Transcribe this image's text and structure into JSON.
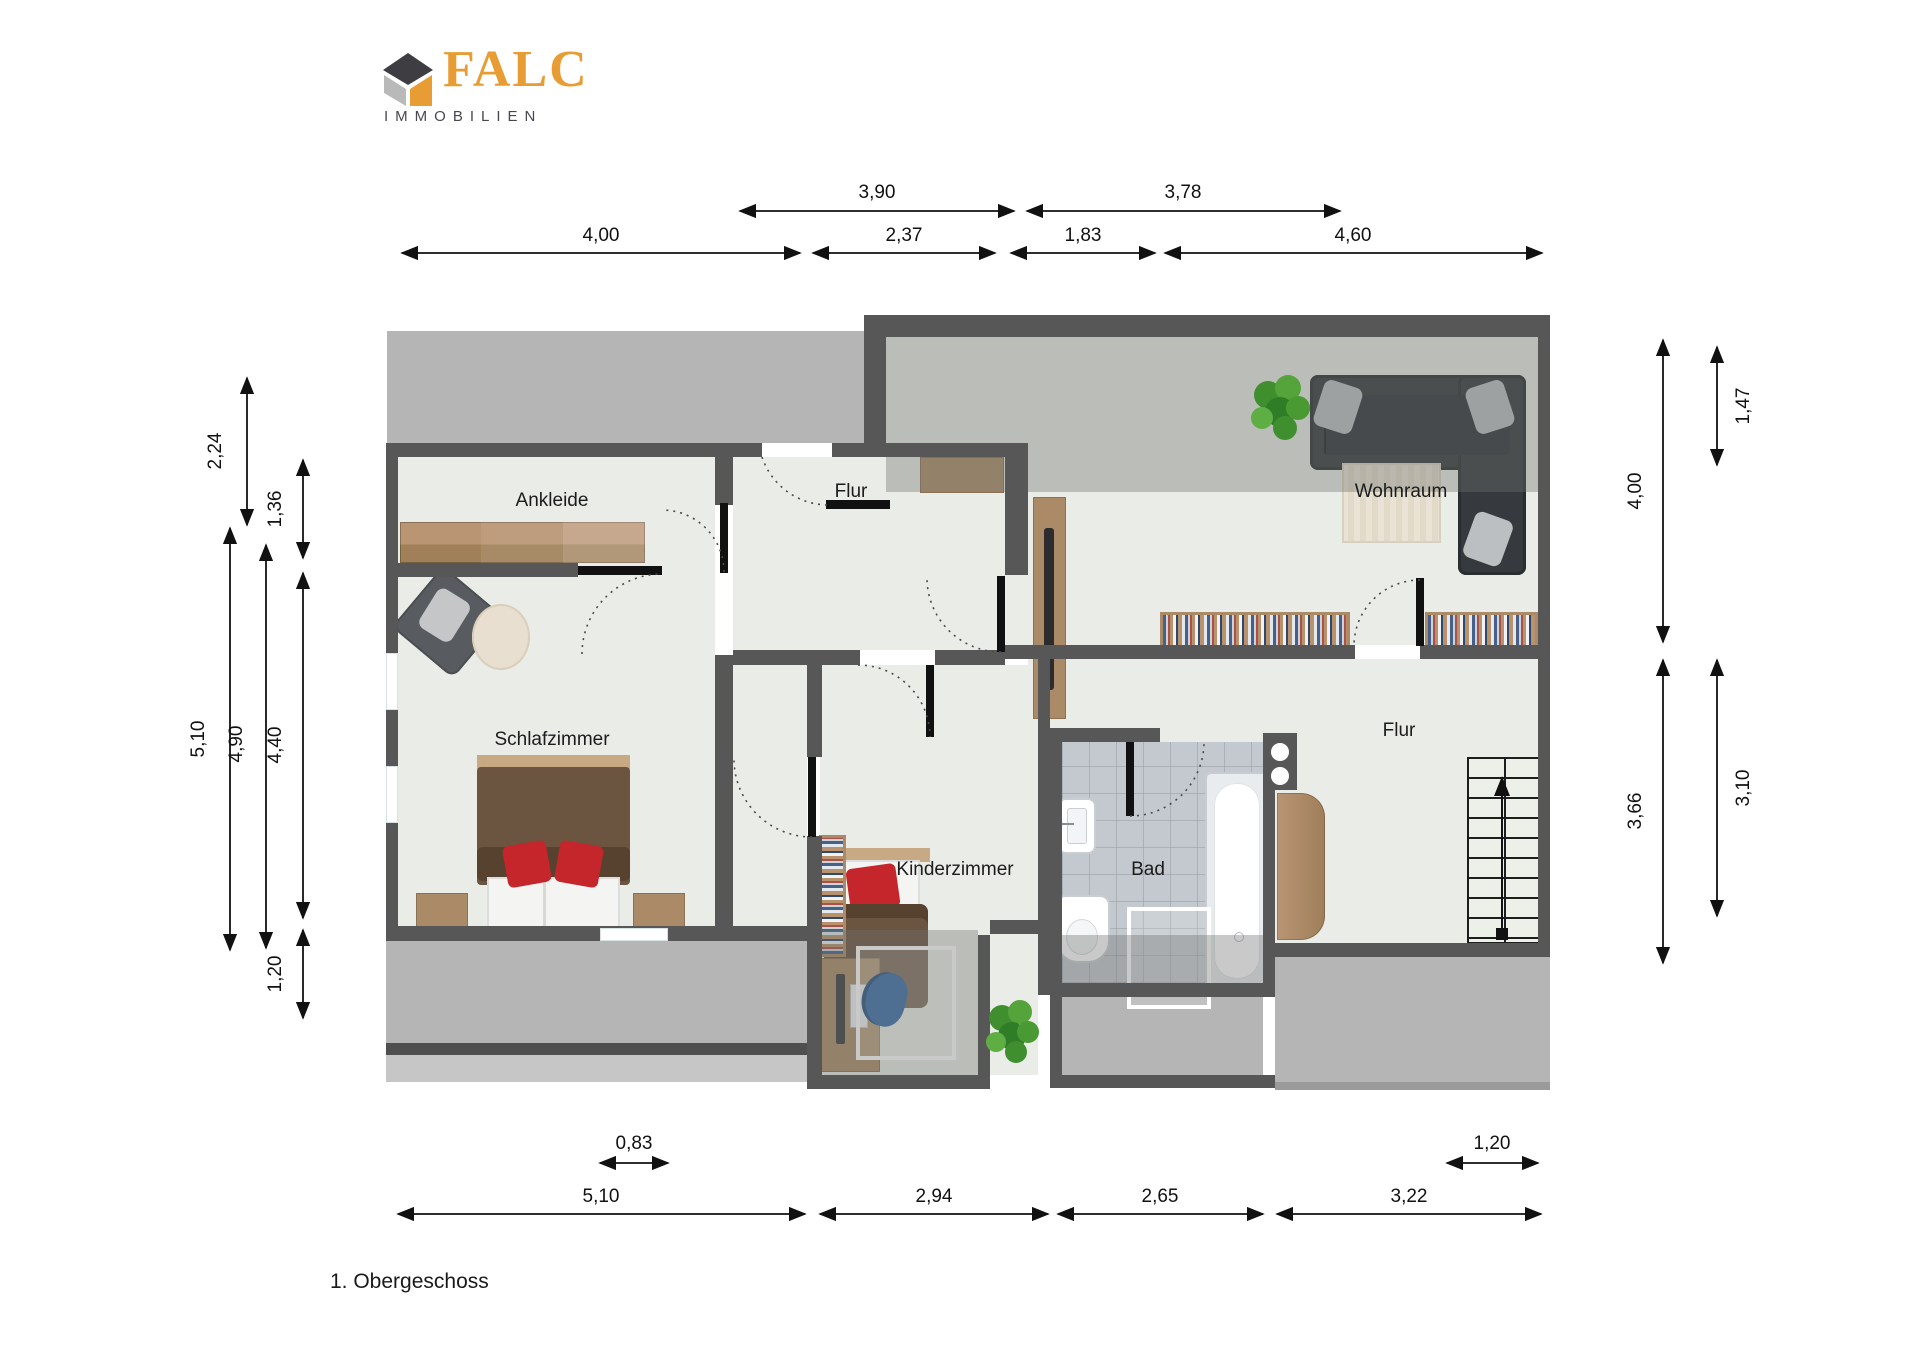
{
  "logo": {
    "brand": "FALC",
    "subtitle": "IMMOBILIEN"
  },
  "caption": "1. Obergeschoss",
  "rooms": {
    "ankleide": "Ankleide",
    "flur_mitte": "Flur",
    "wohnraum": "Wohnraum",
    "schlafzimmer": "Schlafzimmer",
    "kinderzimmer": "Kinderzimmer",
    "bad": "Bad",
    "flur_rechts": "Flur"
  },
  "dimensions": {
    "top_row1": {
      "w390": "3,90",
      "w378": "3,78"
    },
    "top_row2": {
      "w400": "4,00",
      "w237": "2,37",
      "w183": "1,83",
      "w460": "4,60"
    },
    "left": {
      "l224": "2,24",
      "l510": "5,10",
      "l490": "4,90",
      "l136": "1,36",
      "l440": "4,40",
      "l120": "1,20"
    },
    "right": {
      "r147": "1,47",
      "r400": "4,00",
      "r366": "3,66",
      "r310": "3,10"
    },
    "bottom_row1": {
      "b083": "0,83",
      "b120": "1,20"
    },
    "bottom_row2": {
      "b510": "5,10",
      "b294": "2,94",
      "b265": "2,65",
      "b322": "3,22"
    }
  },
  "colors": {
    "wall": "#575757",
    "floor": "#eaece7",
    "roof_shade": "#b5b5b5",
    "brand_orange": "#e79d33",
    "wood": "#ab8b67",
    "tile": "#c3c9cf",
    "sofa": "#36393d",
    "accent_red": "#c4262b",
    "chair_blue": "#3a6ea8"
  }
}
